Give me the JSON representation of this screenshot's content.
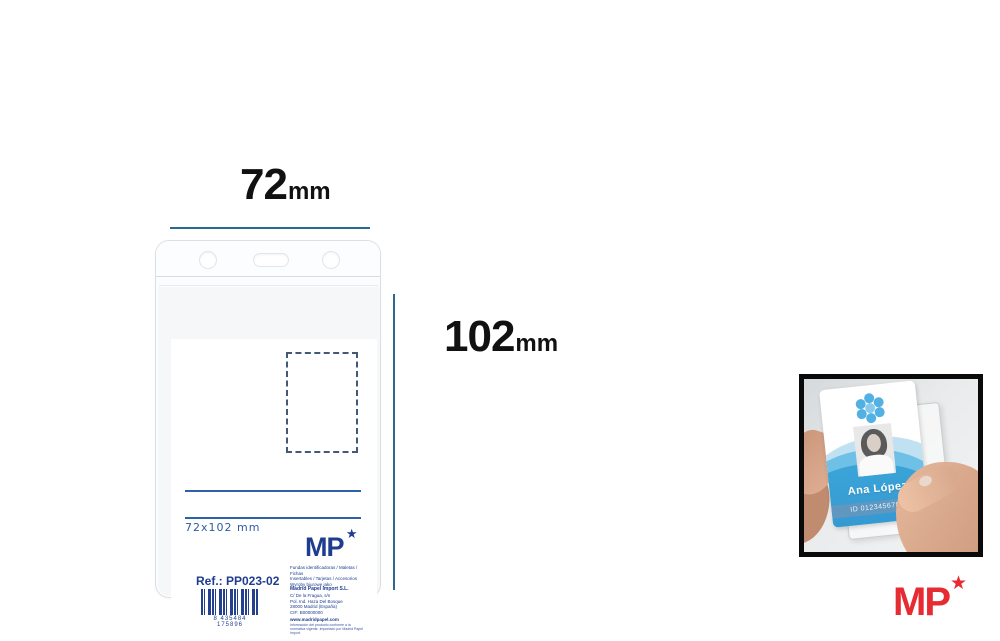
{
  "dimensions": {
    "width": {
      "value": "72",
      "unit": "mm"
    },
    "height": {
      "value": "102",
      "unit": "mm"
    }
  },
  "holder": {
    "insert": {
      "size_label": "72x102 mm",
      "logo": {
        "text": "MP",
        "star": "★"
      },
      "info_lines": [
        "Fundas identificadoras / Maletas / Fichas",
        "Insertables / Tarjetas / Accesorios",
        "Wyroby biurowe jako",
        "Madrid Papel Import S.L.",
        "C/ De la Fragua, s/n",
        "Pol. Ind. Haza Del Bosque",
        "28000 Madrid (España)",
        "CIF: B00000000",
        "www.madridpapel.com",
        "Información del producto conforme a la normativa vigente. Importado por Madrid Papel Import."
      ],
      "ref_label": "Ref.: PP023-02",
      "barcode_digits": "8 435484 175896"
    }
  },
  "photo_inset": {
    "card": {
      "name": "Ana López",
      "id_number": "ID 01234567890"
    }
  },
  "brand": {
    "logo_text": "MP",
    "logo_star": "★",
    "accent_red": "#e62b33",
    "accent_navy": "#1e3d8f",
    "dimension_line_color": "#2b6a8e"
  }
}
